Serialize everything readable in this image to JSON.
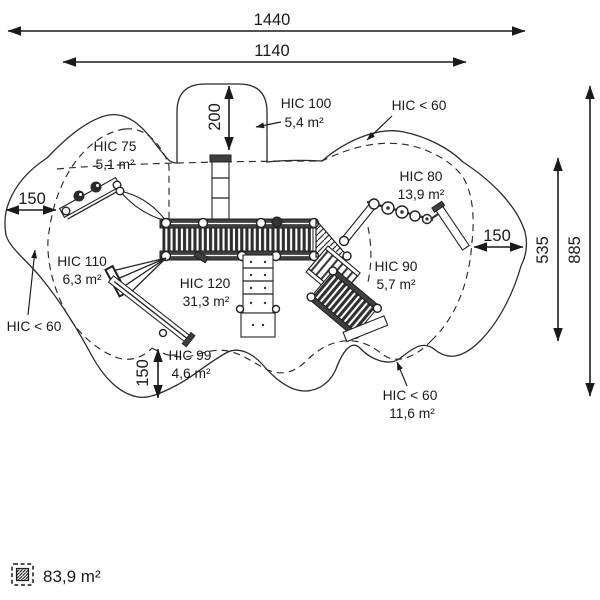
{
  "figure": {
    "title": "playground safety zone plan",
    "dims": {
      "width_outer": "1440",
      "width_inner": "1140",
      "height_outer": "885",
      "height_inner": "535",
      "top_offset": "200",
      "left_offset": "150",
      "right_offset": "150",
      "bottom_offset": "150"
    },
    "zones": [
      {
        "id": "hic-75",
        "label": "HIC 75",
        "area": "5,1 m²"
      },
      {
        "id": "hic-100",
        "label": "HIC 100",
        "area": "5,4 m²"
      },
      {
        "id": "hic-lt-60-top",
        "label": "HIC < 60",
        "area": ""
      },
      {
        "id": "hic-80",
        "label": "HIC 80",
        "area": "13,9 m²"
      },
      {
        "id": "hic-110",
        "label": "HIC 110",
        "area": "6,3 m²"
      },
      {
        "id": "hic-lt-60-left",
        "label": "HIC < 60",
        "area": ""
      },
      {
        "id": "hic-120",
        "label": "HIC 120",
        "area": "31,3 m²"
      },
      {
        "id": "hic-99",
        "label": "HIC 99",
        "area": "4,6 m²"
      },
      {
        "id": "hic-90",
        "label": "HIC 90",
        "area": "5,7 m²"
      },
      {
        "id": "hic-lt-60-bottom",
        "label": "HIC < 60",
        "area": "11,6 m²"
      }
    ],
    "legend": {
      "total_area": "83,9 m²"
    },
    "colors": {
      "line": "#2b2b2b",
      "background": "#ffffff"
    }
  }
}
